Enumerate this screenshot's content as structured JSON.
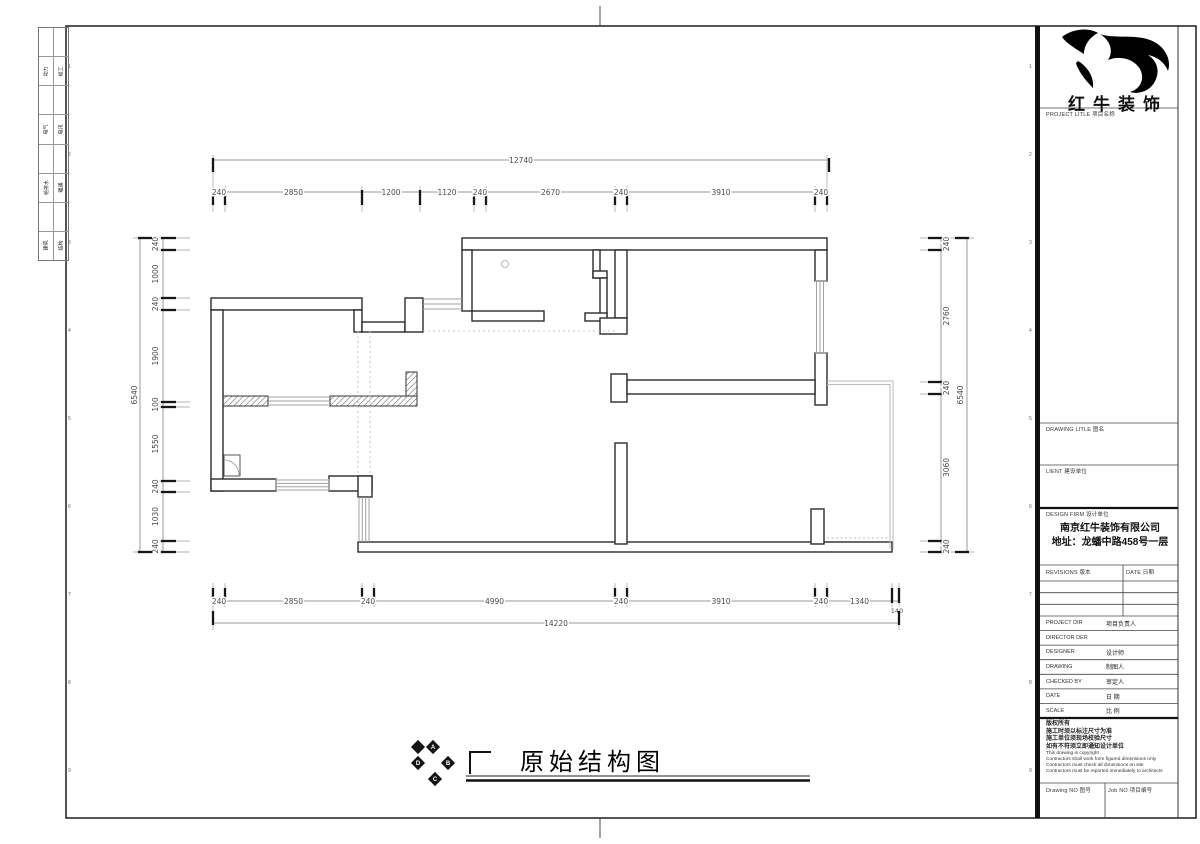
{
  "sheet": {
    "discipline_strip": [
      {
        "left": "动力",
        "right": "竣工"
      },
      {
        "left": "电气",
        "right": "电讯"
      },
      {
        "left": "给排水",
        "right": "暖通"
      },
      {
        "left": "建筑",
        "right": "结构"
      }
    ],
    "grid_numbers": [
      "1",
      "2",
      "3",
      "4",
      "5",
      "6",
      "7",
      "8",
      "9"
    ]
  },
  "plan": {
    "dimensions": {
      "top_overall": "12740",
      "top_chain": [
        "240",
        "2850",
        "1200",
        "1120",
        "240",
        "2670",
        "240",
        "3910",
        "240"
      ],
      "bottom_chain": [
        "240",
        "2850",
        "240",
        "4990",
        "240",
        "3910",
        "240",
        "1340"
      ],
      "bottom_extra": "140",
      "bottom_overall": "14220",
      "left_chain": [
        "240",
        "1000",
        "240",
        "1900",
        "100",
        "1550",
        "240",
        "1030",
        "240"
      ],
      "left_overall": "6540",
      "right_chain": [
        "240",
        "2760",
        "240",
        "3060",
        "240"
      ],
      "right_overall": "6540"
    }
  },
  "title_bar": {
    "compass_letters": [
      "A",
      "B",
      "C",
      "D"
    ],
    "drawing_title": "原始结构图"
  },
  "title_block": {
    "logo_text": "红牛装饰",
    "project_title_label": "PROJECT LITLE  项目名称",
    "drawing_title_label": "DRAWING LITLE  图名",
    "client_label": "LIENT  建设单位",
    "design_firm_label": "DESIGN FIRM  设计单位",
    "company_name": "南京红牛装饰有限公司",
    "company_address": "地址：龙蟠中路458号一层",
    "revisions_label": "REVISIONS  版本",
    "date_col_label": "DATE  日期",
    "personnel_rows": [
      {
        "en": "PROJECT DIR",
        "zh": "项目负责人"
      },
      {
        "en": "DIRECTOR DER",
        "zh": ""
      },
      {
        "en": "DESIGNER",
        "zh": "设计师"
      },
      {
        "en": "DRAWING",
        "zh": "制图人"
      },
      {
        "en": "CHECKED BY",
        "zh": "审定人"
      },
      {
        "en": "DATE",
        "zh": "日  期"
      },
      {
        "en": "SCALE",
        "zh": "比  例"
      }
    ],
    "notes_zh": [
      "版权所有",
      "施工时须以标注尺寸为准",
      "施工单位须现场校验尺寸",
      "如有不符须立即通知设计单位"
    ],
    "notes_en": [
      "This drawing is copyright",
      "Contractors shall work form figured dimensions only",
      "Contractors must check all dimensions on site",
      "Contractors must be reported immediately to architects"
    ],
    "drawing_no_label": "Drawing NO  图号",
    "job_no_label": "Job NO  项目编号"
  },
  "colors": {
    "wall": "#2b2b2b",
    "dim_line": "#9a9a9a",
    "dim_text": "#4a4a4a",
    "window": "#a0a0a0",
    "light": "#bcbcbc",
    "black": "#111111"
  }
}
